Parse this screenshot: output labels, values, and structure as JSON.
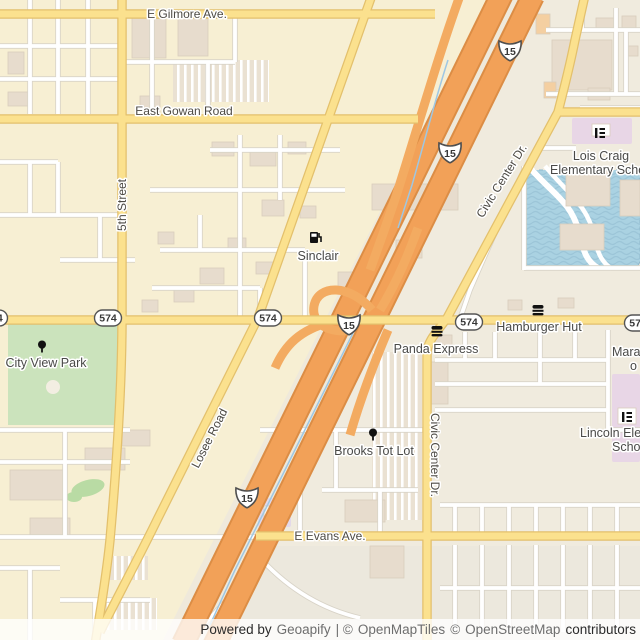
{
  "map_labels": {
    "gilmore": "E Gilmore Ave.",
    "gowan": "East Gowan Road",
    "fifth_street": "5th Street",
    "losee": "Losee Road",
    "civic_center": "Civic Center Dr.",
    "evans": "E Evans Ave."
  },
  "shields": {
    "interstate_15": "15",
    "route_574": "574"
  },
  "pois": {
    "sinclair": "Sinclair",
    "panda_express": "Panda Express",
    "hamburger_hut": "Hamburger Hut",
    "city_view_park": "City View Park",
    "brooks_tot_lot": "Brooks Tot Lot",
    "lois_craig_line1": "Lois Craig",
    "lois_craig_line2": "Elementary Scho",
    "lincoln_line1": "Lincoln Ele",
    "lincoln_line2": "Schoo",
    "maravilla_line1": "Mara",
    "maravilla_line2": "o"
  },
  "attribution": {
    "powered_by": "Powered by",
    "geoapify": "Geoapify",
    "sep1": "| ©",
    "openmaptiles": "OpenMapTiles",
    "sep2": "©",
    "openstreetmap": "OpenStreetMap",
    "contributors": "contributors"
  },
  "colors": {
    "land_west": "#f7efd3",
    "land_east": "#f0ebde",
    "freeway": "#f2a158",
    "road_yellow": "#fbe18e",
    "water": "#aad2e2",
    "park": "#cbe3bc",
    "school_area": "#e8d6e6"
  }
}
